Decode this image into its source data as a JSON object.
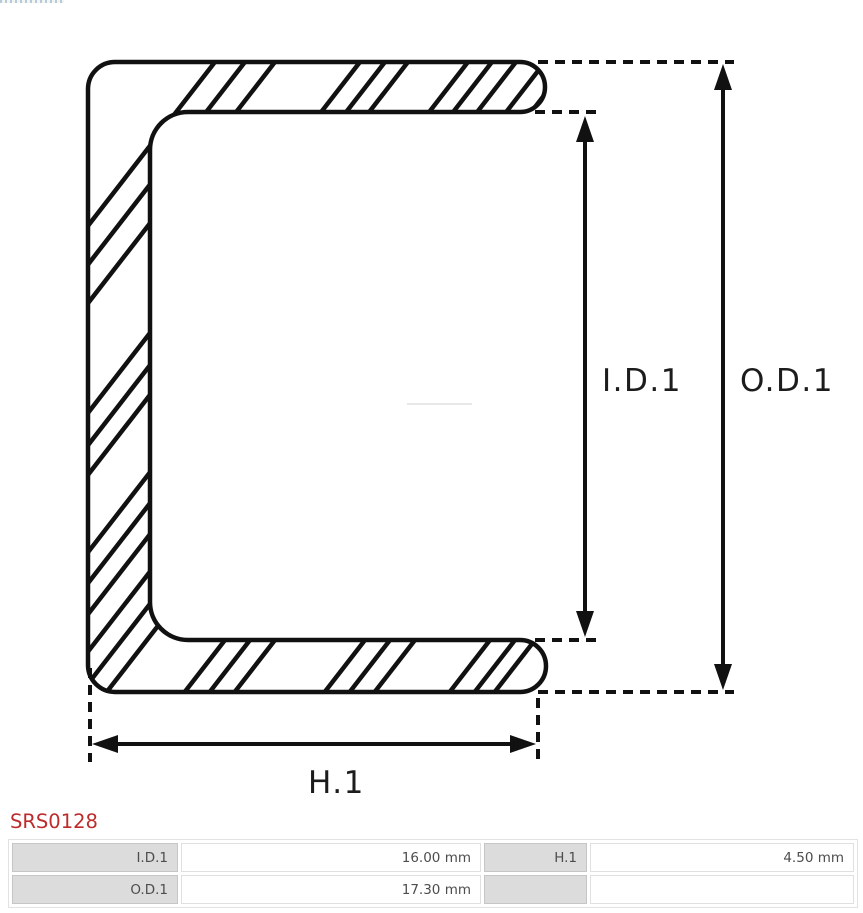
{
  "diagram": {
    "labels": {
      "id1": "I.D.1",
      "od1": "O.D.1",
      "h1": "H.1"
    },
    "stroke_color": "#111111"
  },
  "part": {
    "number": "SRS0128",
    "color": "#bd2c2c"
  },
  "spec_table": {
    "label_bg": "#dcdcdc",
    "rows": [
      {
        "cells": [
          "I.D.1",
          "16.00 mm",
          "H.1",
          "4.50 mm"
        ]
      },
      {
        "cells": [
          "O.D.1",
          "17.30 mm",
          "",
          ""
        ]
      }
    ]
  }
}
